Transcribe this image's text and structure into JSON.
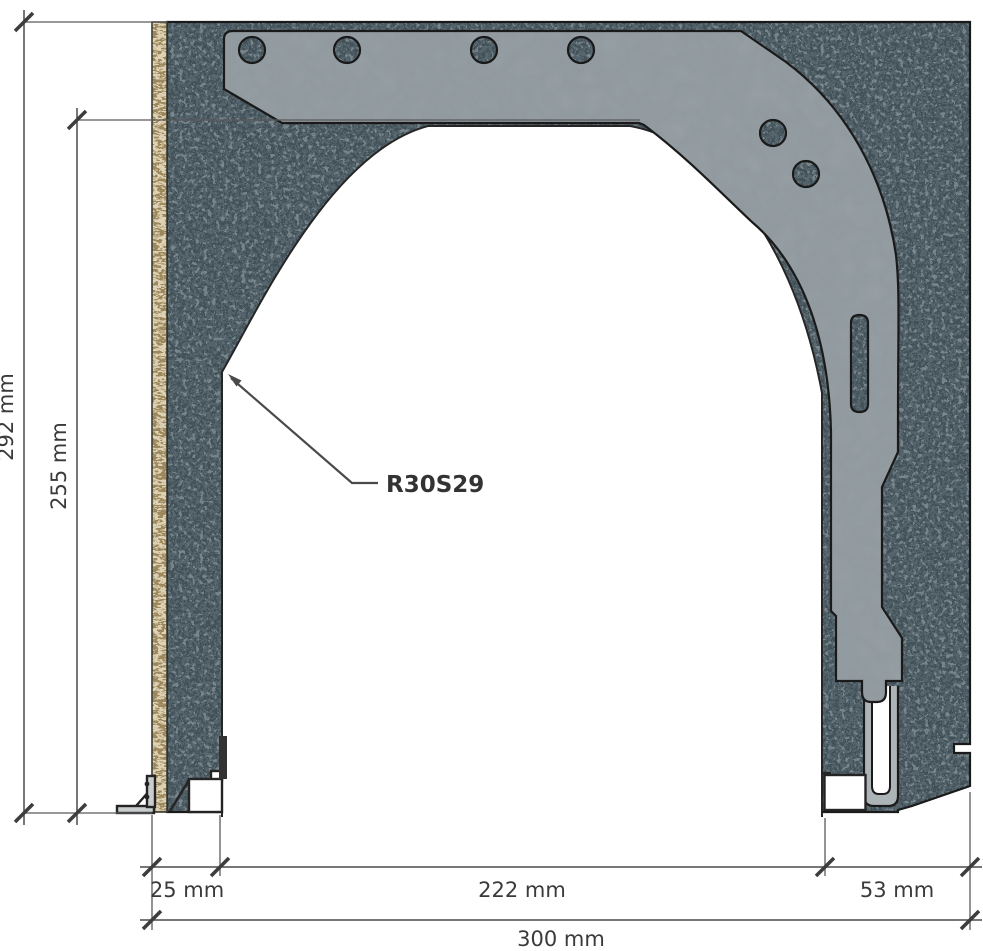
{
  "drawing": {
    "label": "R30S29",
    "dims": {
      "total_height": "292 mm",
      "inner_height": "255 mm",
      "left_wall": "25 mm",
      "opening_width": "222 mm",
      "right_wall": "53 mm",
      "total_width": "300 mm"
    },
    "colors": {
      "wall_base": "#5d6c74",
      "wall_dark_speckle": "#39484f",
      "wall_light_speckle": "#8a979c",
      "osb_strip": "#ddd2b4",
      "osb_grain": "#8d7648",
      "side_cap": "#9ba3a7",
      "guide_rail": "#adb4b7",
      "outline": "#1a1a1a",
      "dimension": "#3d3d3d",
      "background": "#ffffff"
    }
  }
}
